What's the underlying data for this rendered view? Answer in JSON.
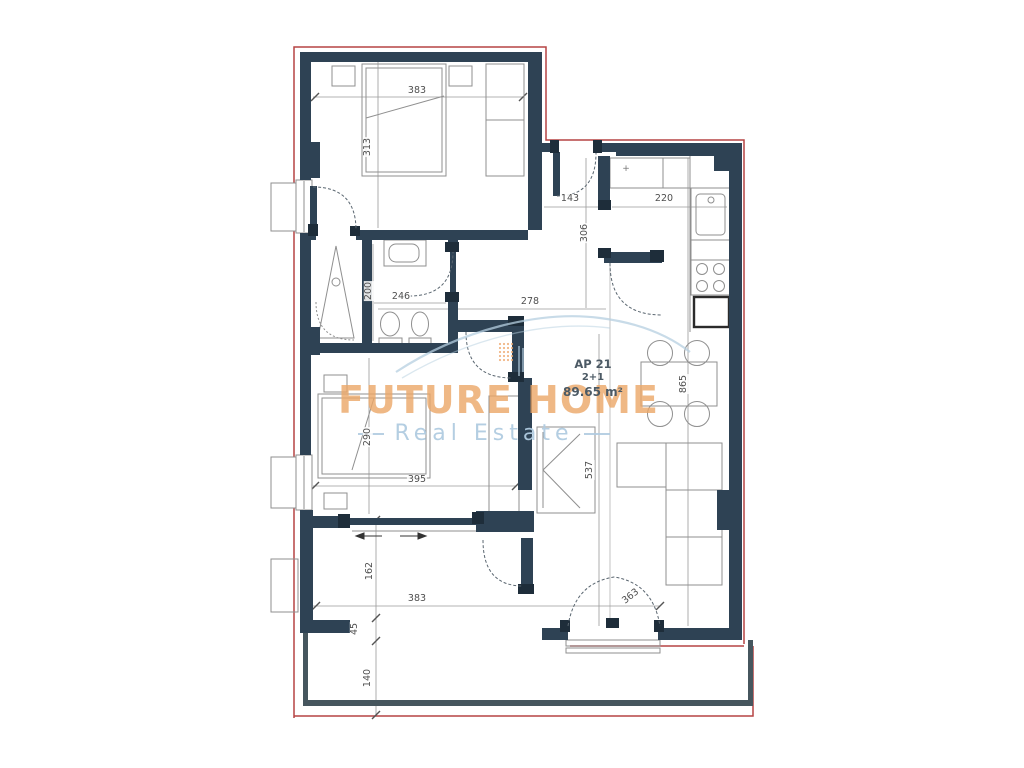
{
  "unit": {
    "id": "AP 21",
    "layout_type": "2+1",
    "area": "89.65 m²"
  },
  "watermark": {
    "brand": "FUTURE HOME",
    "tagline": "Real Estate"
  },
  "dims": {
    "bedroom1_width": "383",
    "bedroom1_depth": "313",
    "entry_width": "143",
    "kitchen_width": "220",
    "hall_depth": "306",
    "bathroom_width": "246",
    "bathroom_depth": "200",
    "hall_length": "278",
    "bedroom2_depth": "290",
    "bedroom2_width": "395",
    "living_length": "865",
    "living_strip": "537",
    "terrace_depth": "162",
    "terrace_width": "383",
    "terrace_step": "45",
    "balcony_depth": "140",
    "balcony_door": "363",
    "kitchen_marker": "+"
  },
  "colors": {
    "wall": "#2e4254",
    "wall_post": "#1e2d3a",
    "balcony_wall": "#46565e",
    "boundary": "#b54444",
    "furniture": "#8f8f8f",
    "dim_line": "#9a9a9a",
    "dim_text": "#4f4f4f",
    "brand_orange": "#eeab72",
    "brand_blue": "#b5cfe0",
    "unit_text": "#4c5a65"
  }
}
